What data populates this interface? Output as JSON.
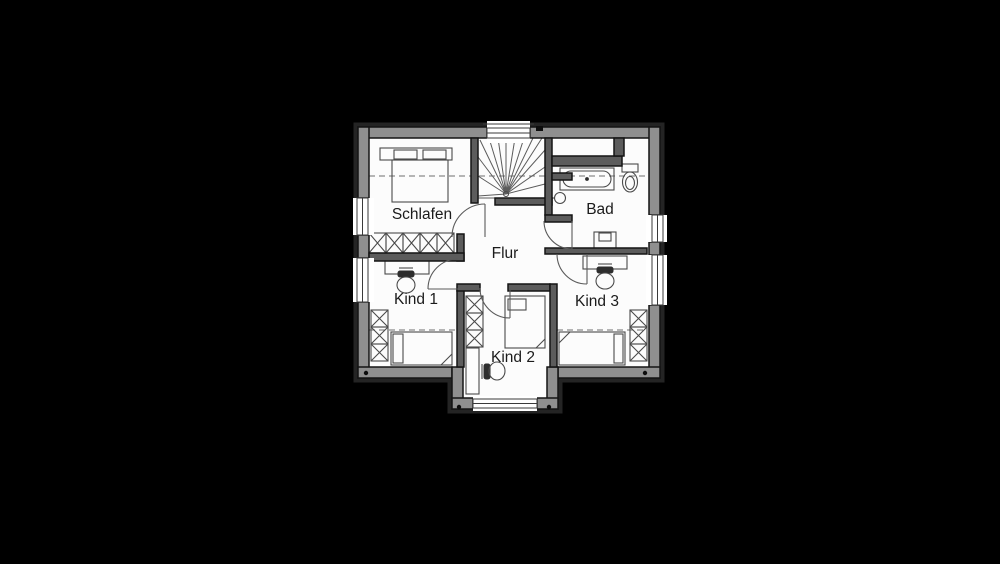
{
  "plan": {
    "type": "architectural-floor-plan",
    "rooms": {
      "schlafen": {
        "label": "Schlafen"
      },
      "bad": {
        "label": "Bad"
      },
      "flur": {
        "label": "Flur"
      },
      "kind1": {
        "label": "Kind 1"
      },
      "kind2": {
        "label": "Kind 2"
      },
      "kind3": {
        "label": "Kind 3"
      }
    },
    "furniture_icons": {
      "schlafen": [
        "double-bed-icon",
        "wardrobe-icon"
      ],
      "bad": [
        "bathtub-icon",
        "toilet-icon",
        "washbasin-icon",
        "sink-icon"
      ],
      "kind1": [
        "desk-icon",
        "office-chair-icon",
        "single-bed-icon",
        "wardrobe-icon"
      ],
      "kind2": [
        "wardrobe-icon",
        "single-bed-icon",
        "desk-icon",
        "office-chair-icon"
      ],
      "kind3": [
        "desk-icon",
        "office-chair-icon",
        "single-bed-icon",
        "wardrobe-icon"
      ],
      "stairwell": [
        "winder-staircase-icon"
      ]
    },
    "colors": {
      "background": "#000000",
      "floor": "#fcfcfc",
      "exterior_wall": "#8f8f8f",
      "interior_wall": "#5c5c5c",
      "outline": "#141414",
      "furniture_line": "#4a4a4a",
      "label": "#1b1b1b"
    }
  }
}
